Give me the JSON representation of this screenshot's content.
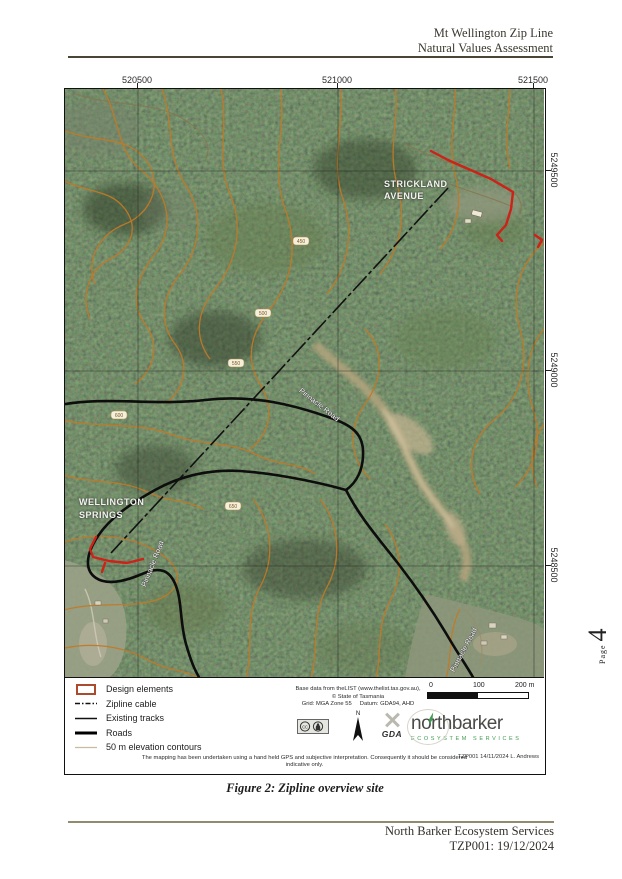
{
  "header": {
    "title_line1": "Mt Wellington Zip Line",
    "title_line2": "Natural Values Assessment"
  },
  "figure": {
    "caption": "Figure 2: Zipline overview site"
  },
  "footer": {
    "org": "North Barker Ecosystem Services",
    "ref": "TZP001: 19/12/2024"
  },
  "page_marker": {
    "label": "Page",
    "number": "4"
  },
  "map": {
    "grid_top": [
      "520500",
      "521000",
      "521500"
    ],
    "grid_right": [
      "5249500",
      "5249000",
      "5248500"
    ],
    "place_labels": {
      "strickland_line1": "STRICKLAND",
      "strickland_line2": "AVENUE",
      "wellington_line1": "WELLINGTON",
      "wellington_line2": "SPRINGS",
      "pinnacle_road": "Pinnacle Road"
    },
    "contour_labels": [
      "450",
      "500",
      "550",
      "600",
      "650"
    ],
    "colors": {
      "forest_base": "#46543a",
      "contour": "#c07a28",
      "road": "#0d0d0d",
      "zipline": "#111111",
      "design_elements": "#cc2218",
      "creek": "#b4a47e"
    }
  },
  "legend": {
    "items": [
      {
        "label": "Design elements"
      },
      {
        "label": "Zipline cable"
      },
      {
        "label": "Existing tracks"
      },
      {
        "label": "Roads"
      },
      {
        "label": "50 m elevation contours"
      }
    ],
    "attribution": {
      "line1": "Base data from theLIST (www.thelist.tas.gov.au),",
      "line2": "© State of Tasmania",
      "grid": "Grid: MGA Zone 55",
      "datum": "Datum: GDA94, AHD"
    },
    "scalebar": {
      "start": "0",
      "mid": "100",
      "end": "200 m"
    },
    "north_label": "N",
    "gda_label": "GDA",
    "cc_label": "cc",
    "brand": {
      "part1": "n",
      "part2": "o",
      "part3": "rthbarker",
      "tagline": "ECOSYSTEM SERVICES",
      "accent_color": "#3f9b4f"
    },
    "doc_ref": "TZP001  14/11/2024 L. Andrews",
    "disclaimer": "The mapping has been undertaken using a hand held GPS and subjective interpretation. Consequently it should be considered indicative only."
  }
}
